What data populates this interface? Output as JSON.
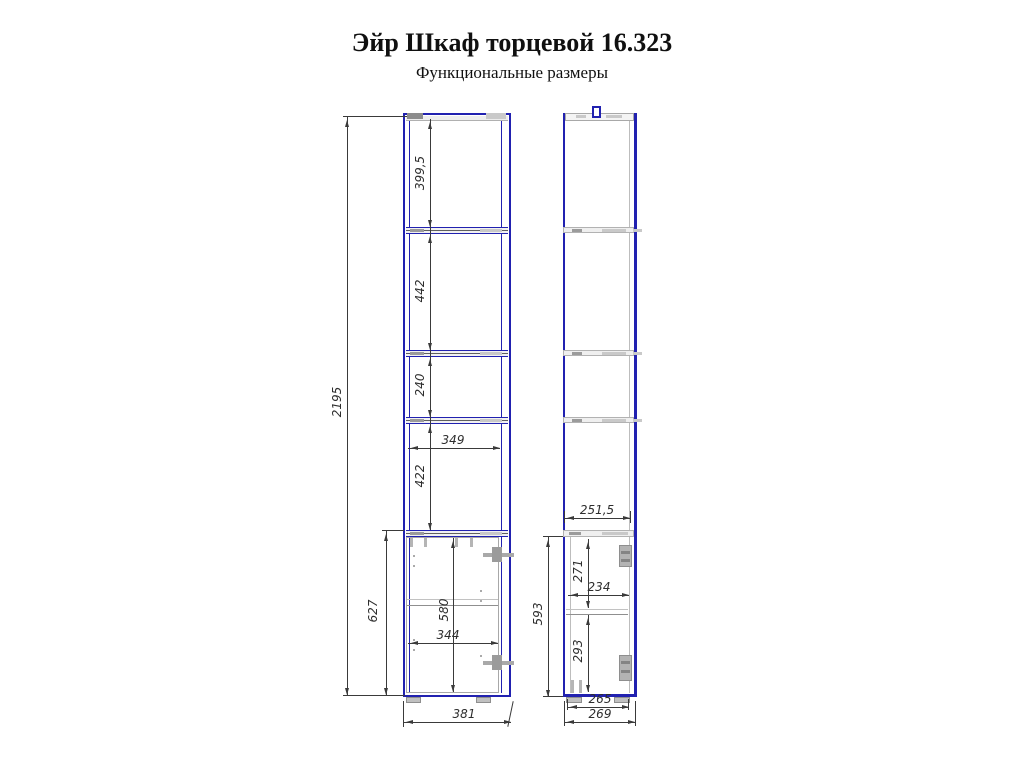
{
  "header": {
    "title": "Эйр Шкаф торцевой 16.323",
    "subtitle": "Функциональные размеры"
  },
  "front": {
    "dims": {
      "overall_height": "2195",
      "section1_height": "399,5",
      "section2_height": "442",
      "section3_height": "240",
      "niche_height": "422",
      "niche_width": "349",
      "base_height": "627",
      "door_height": "580",
      "door_width": "344",
      "overall_width": "381"
    }
  },
  "side": {
    "dims": {
      "top_shelf_depth": "251,5",
      "base_height": "593",
      "upper_compartment_height": "271",
      "compartment_depth": "234",
      "lower_compartment_height": "293",
      "inner_depth": "265",
      "overall_depth": "269"
    }
  },
  "colors": {
    "outline_blue": "#2121b0",
    "dimension_line": "#3a3a3a",
    "hardware_gray": "#a9a9a9"
  }
}
